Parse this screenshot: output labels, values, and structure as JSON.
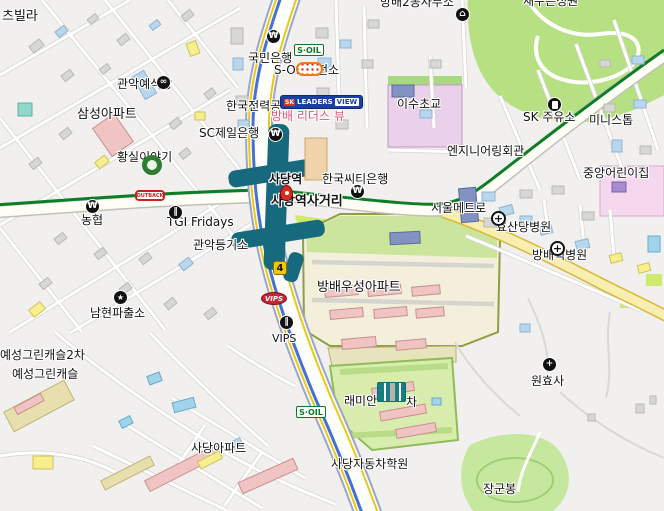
{
  "map": {
    "kind": "city-street-map",
    "labels": [
      {
        "id": "villa-partial",
        "text": "츠빌라",
        "x": 2,
        "y": 10,
        "size": 13
      },
      {
        "id": "gwanak-wedding-hall",
        "text": "관악예식장",
        "x": 117,
        "y": 78,
        "size": 12
      },
      {
        "id": "samsung-apt",
        "text": "삼성아파트",
        "x": 77,
        "y": 108,
        "size": 13
      },
      {
        "id": "hwangsil-story",
        "text": "황실이야기",
        "x": 117,
        "y": 151,
        "size": 12
      },
      {
        "id": "kookmin-bank",
        "text": "국민은행",
        "x": 248,
        "y": 52,
        "size": 12
      },
      {
        "id": "soil-charging-station",
        "text": "S-OIL충전소",
        "x": 274,
        "y": 64,
        "size": 12
      },
      {
        "id": "kepco",
        "text": "한국전력공사",
        "x": 226,
        "y": 100,
        "size": 12
      },
      {
        "id": "bangbae-leaders-view",
        "text": "방배 리더스 뷰",
        "x": 271,
        "y": 110,
        "size": 12,
        "color": "#e05878"
      },
      {
        "id": "sc-first-bank",
        "text": "SC제일은행",
        "x": 199,
        "y": 127,
        "size": 12
      },
      {
        "id": "isu-elementary",
        "text": "이수초교",
        "x": 397,
        "y": 98,
        "size": 12
      },
      {
        "id": "sk-gas-station",
        "text": "SK 주유소",
        "x": 523,
        "y": 111,
        "size": 12
      },
      {
        "id": "ministop",
        "text": "미니스톱",
        "x": 589,
        "y": 114,
        "size": 12
      },
      {
        "id": "bangbae2dong-office",
        "text": "방배2동사무소",
        "x": 380,
        "y": -4,
        "size": 12
      },
      {
        "id": "park-name",
        "text": "새수은성원",
        "x": 523,
        "y": -5,
        "size": 12
      },
      {
        "id": "engineering-hall",
        "text": "엔지니어링회관",
        "x": 447,
        "y": 145,
        "size": 12
      },
      {
        "id": "jungang-daycare",
        "text": "중앙어린이집",
        "x": 583,
        "y": 167,
        "size": 12
      },
      {
        "id": "sadang-station",
        "text": "사당역",
        "x": 269,
        "y": 173,
        "size": 12,
        "bold": true
      },
      {
        "id": "sadang-intersection",
        "text": "사당역사거리",
        "x": 271,
        "y": 195,
        "size": 13,
        "bold": true
      },
      {
        "id": "citibank-korea",
        "text": "한국씨티은행",
        "x": 322,
        "y": 173,
        "size": 12
      },
      {
        "id": "seoul-metro",
        "text": "서울메트로",
        "x": 431,
        "y": 202,
        "size": 12
      },
      {
        "id": "tgi-fridays",
        "text": "TGI Fridays",
        "x": 167,
        "y": 216,
        "size": 12
      },
      {
        "id": "gwanak-registry",
        "text": "관악등기소",
        "x": 193,
        "y": 239,
        "size": 12
      },
      {
        "id": "nonghyup",
        "text": "농협",
        "x": 81,
        "y": 214,
        "size": 12
      },
      {
        "id": "namhyeon-police",
        "text": "남현파출소",
        "x": 90,
        "y": 307,
        "size": 12
      },
      {
        "id": "hyosandang-hospital",
        "text": "효산당병원",
        "x": 496,
        "y": 221,
        "size": 12
      },
      {
        "id": "bangbae-hospital",
        "text": "방배척병원",
        "x": 532,
        "y": 249,
        "size": 12
      },
      {
        "id": "bangbae-woosung-apt",
        "text": "방배우성아파트",
        "x": 317,
        "y": 281,
        "size": 13
      },
      {
        "id": "wonhyosa-temple",
        "text": "원효사",
        "x": 531,
        "y": 375,
        "size": 12
      },
      {
        "id": "yeseong-green-castle-2",
        "text": "예성그린캐슬2차",
        "x": 0,
        "y": 349,
        "size": 12
      },
      {
        "id": "yeseong-green-castle",
        "text": "예성그린캐슬",
        "x": 12,
        "y": 368,
        "size": 12
      },
      {
        "id": "vips-text",
        "text": "VIPS",
        "x": 272,
        "y": 333,
        "size": 11
      },
      {
        "id": "raemian-name-left",
        "text": "래미안",
        "x": 344,
        "y": 395,
        "size": 12
      },
      {
        "id": "raemian-name-right",
        "text": "차",
        "x": 406,
        "y": 396,
        "size": 12
      },
      {
        "id": "sadang-driving-school",
        "text": "사당자동차학원",
        "x": 331,
        "y": 458,
        "size": 12
      },
      {
        "id": "sadang-apt",
        "text": "사당아파트",
        "x": 191,
        "y": 442,
        "size": 12
      },
      {
        "id": "janggun-peak",
        "text": "장군봉",
        "x": 483,
        "y": 483,
        "size": 12
      }
    ],
    "icons": [
      {
        "type": "bank",
        "x": 266,
        "y": 29
      },
      {
        "type": "bank",
        "x": 268,
        "y": 127
      },
      {
        "type": "bank",
        "x": 350,
        "y": 184
      },
      {
        "type": "bank",
        "x": 85,
        "y": 199
      },
      {
        "type": "government",
        "x": 455,
        "y": 7
      },
      {
        "type": "gas",
        "x": 547,
        "y": 97
      },
      {
        "type": "police",
        "x": 113,
        "y": 290
      },
      {
        "type": "hospital",
        "x": 491,
        "y": 211
      },
      {
        "type": "hospital",
        "x": 550,
        "y": 241
      },
      {
        "type": "temple",
        "x": 542,
        "y": 357
      },
      {
        "type": "restaurant",
        "x": 168,
        "y": 205
      },
      {
        "type": "restaurant",
        "x": 279,
        "y": 315
      },
      {
        "type": "wedding",
        "x": 156,
        "y": 75
      },
      {
        "type": "traffic",
        "x": 280,
        "y": 185
      },
      {
        "type": "hwangsil-logo",
        "x": 142,
        "y": 155
      },
      {
        "type": "apartment-symbol",
        "x": 377,
        "y": 382
      },
      {
        "type": "franchise",
        "x": 296,
        "y": 62
      }
    ],
    "badges": {
      "soil": {
        "text": "S·OIL",
        "positions": [
          {
            "x": 294,
            "y": 44
          },
          {
            "x": 296,
            "y": 406
          }
        ]
      },
      "leaders_view": {
        "sk": "SK",
        "name": "LEADERS",
        "suffix": "VIEW",
        "x": 280,
        "y": 95
      },
      "outback": {
        "text": "OUTBACK",
        "x": 135,
        "y": 190
      },
      "vips": {
        "text": "VIPS",
        "x": 261,
        "y": 292
      },
      "line4": {
        "text": "4",
        "x": 273,
        "y": 261
      }
    },
    "colors": {
      "station_teal": "#17697e",
      "line2_green": "#0e7d28",
      "line4_blue": "#4671d4",
      "road_yellow_line": "#e8c818",
      "highway_fill": "#f8eeb0",
      "park_green": "#b7e083",
      "hill_green": "#c6e89e",
      "school_pink": "#ead0ea",
      "complex_olive": "#8f9e45",
      "label_pink": "#e05878",
      "soil_green": "#0a7a28",
      "leaders_blue": "#1b3fa0",
      "vips_red": "#cc2233",
      "outback_red": "#cc2020",
      "line4_badge_yellow": "#f4c60a"
    }
  }
}
